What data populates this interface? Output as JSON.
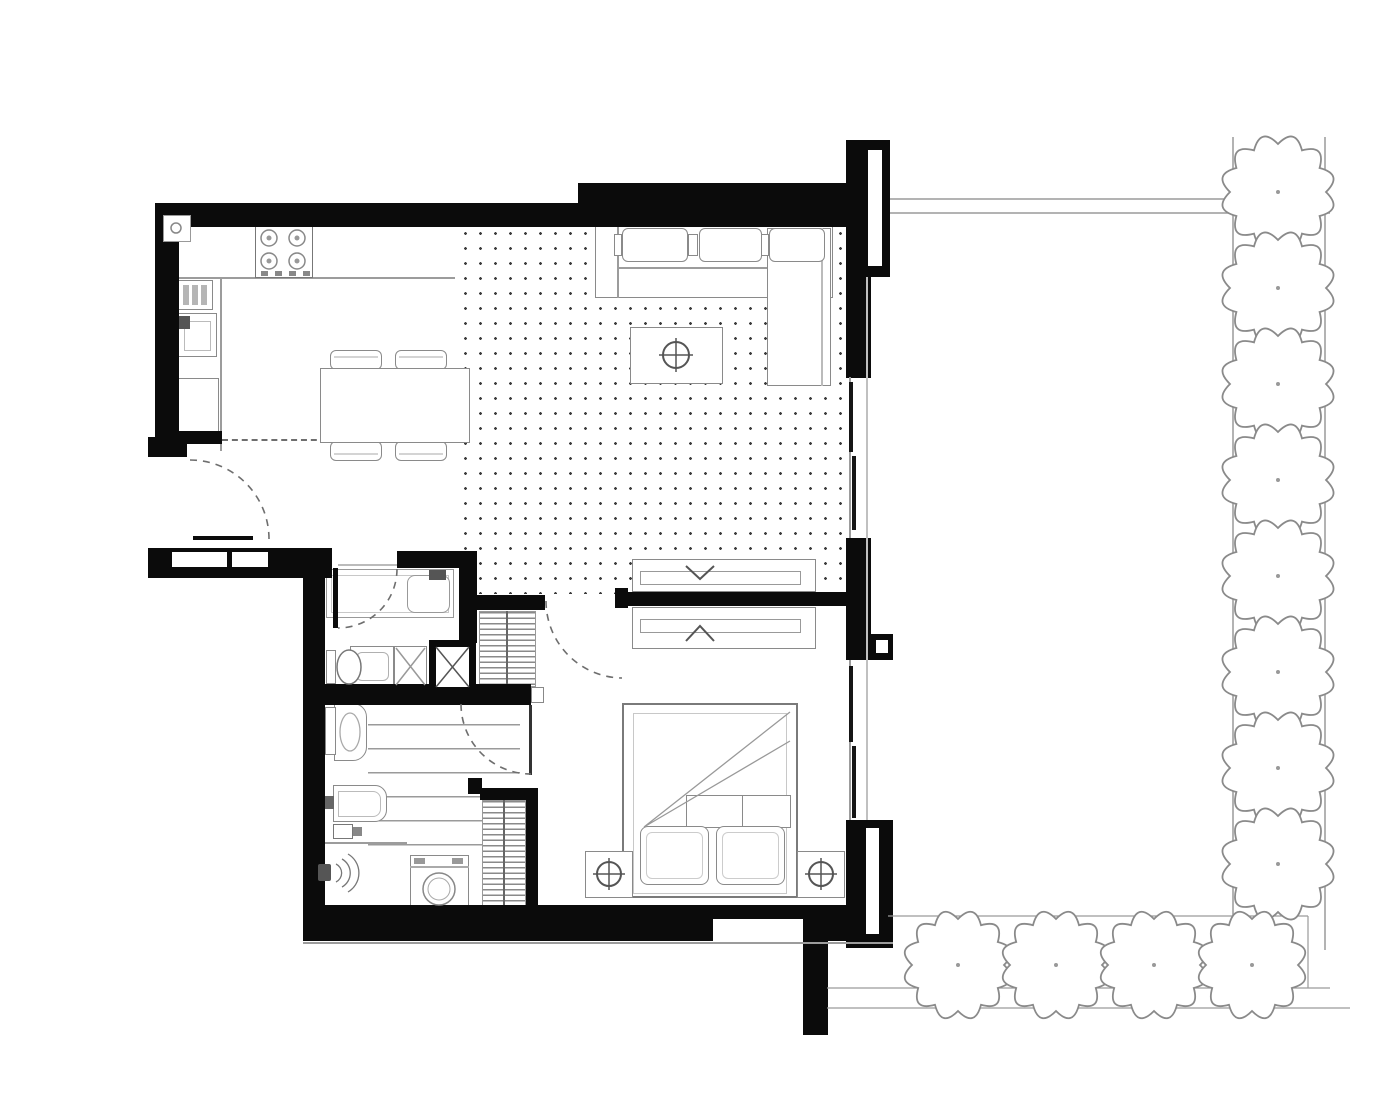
{
  "drawing": {
    "type": "apartment floor plan, top view, black and white architectural linework",
    "rooms": [
      "entry-hall",
      "kitchen-dining",
      "living-room",
      "bathroom",
      "walk-through-closet-laundry",
      "bedroom",
      "garden"
    ],
    "palette": {
      "walls": "#0b0b0b",
      "furniture_line": "#8a8a8a",
      "floor_dots": "#3d3d3d",
      "landscape_line": "#9a9a9a",
      "background": "#ffffff"
    }
  },
  "kitchen": {
    "stove_burners": 4,
    "fixtures": [
      "cooktop",
      "dish-rack",
      "sink",
      "tall-cabinet"
    ],
    "dining_table": 1,
    "dining_chairs": 4
  },
  "living_room": {
    "floor_pattern": "dot-grid",
    "sofa_back_cushions": 3,
    "furniture": [
      "l-shaped-sofa",
      "coffee-table-with-decor"
    ]
  },
  "bathroom": {
    "fixtures": [
      "bathtub",
      "toilet",
      "washbasin",
      "corner-shower",
      "service-shaft-x"
    ]
  },
  "closet_laundry": {
    "fixtures": [
      "toilet",
      "washbasin",
      "valve-box",
      "walk-in-shower",
      "washing-machine"
    ],
    "shelf_rows": 7,
    "wardrobes": 2
  },
  "bedroom": {
    "bed": "double bed with 2 pillows and folded throw",
    "nightstands": 2,
    "lamps": 2,
    "sliding_units_with_chevrons": 2
  },
  "doors": {
    "swing_arcs": 4,
    "door_leaves": [
      "entry",
      "bathroom",
      "closet"
    ]
  },
  "garden": {
    "tree_count": 12,
    "side_tree_radius": 48,
    "bottom_tree_radius": 46,
    "side_trees": [
      [
        1278,
        192
      ],
      [
        1278,
        288
      ],
      [
        1278,
        384
      ],
      [
        1278,
        480
      ],
      [
        1278,
        576
      ],
      [
        1278,
        672
      ],
      [
        1278,
        768
      ],
      [
        1278,
        864
      ]
    ],
    "bottom_trees": [
      [
        958,
        965
      ],
      [
        1056,
        965
      ],
      [
        1154,
        965
      ],
      [
        1252,
        965
      ]
    ]
  }
}
